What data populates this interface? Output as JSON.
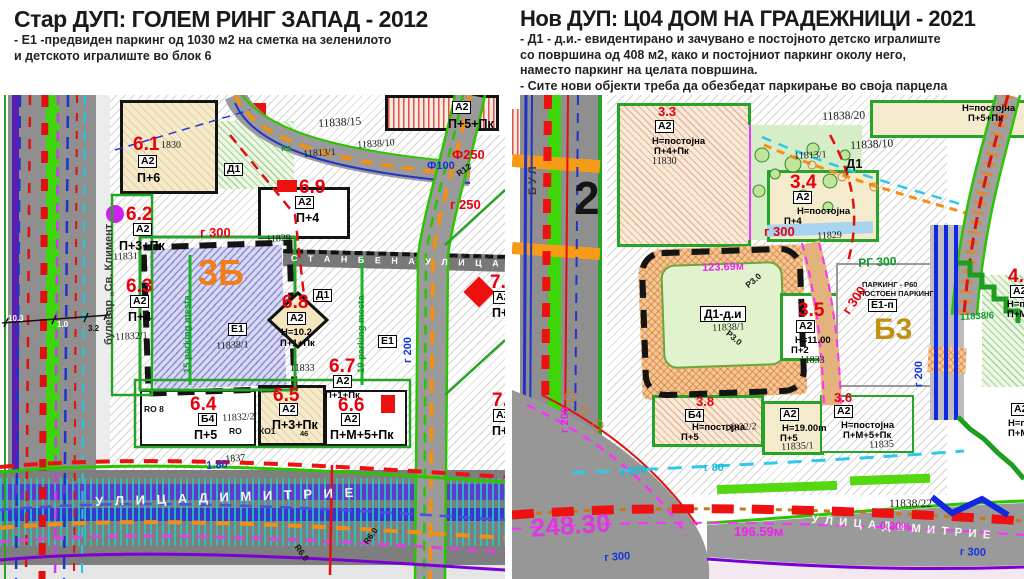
{
  "left_panel": {
    "title": "Стар ДУП: ГОЛЕМ РИНГ ЗАПАД - 2012",
    "notes": [
      "- Е1 -предвиден паркинг од 1030 м2 на сметка на зеленилото",
      "и детското игралиште во блок 6"
    ]
  },
  "right_panel": {
    "title": "Нов ДУП: Ц04 ДОМ НА ГРАДЕЖНИЦИ - 2021",
    "notes": [
      "- Д1 - д.и.- евидентирано и зачувано е постојното детско игралиште",
      "со површина од 408 м2, како и постојниот паркинг околу него,",
      "наместо паркинг на целата површина.",
      "- Сите нови објекти треба да обезбедат паркирање во своја парцела"
    ]
  },
  "left_map": {
    "caption": "Стар ДУП 2012 - урбанистичка карта",
    "labels": [
      {
        "n": "street-name-blvd",
        "t": "булевар „Св. Климент",
        "x": 104,
        "y": 250,
        "c": "blvd",
        "r": -90
      },
      {
        "n": "label-6-1",
        "t": "6.1",
        "x": 133,
        "y": 40,
        "c": "red"
      },
      {
        "n": "parcel-1830",
        "t": "1830",
        "x": 161,
        "y": 46,
        "c": "par"
      },
      {
        "n": "label-6-1-class",
        "t": "А2",
        "x": 138,
        "y": 60,
        "c": "box"
      },
      {
        "n": "label-6-1-storeys",
        "t": "П+6",
        "x": 137,
        "y": 77,
        "c": "st"
      },
      {
        "n": "label-6-2",
        "t": "6.2",
        "x": 126,
        "y": 110,
        "c": "red"
      },
      {
        "n": "label-6-2-class",
        "t": "А2",
        "x": 133,
        "y": 128,
        "c": "box"
      },
      {
        "n": "label-6-2-storeys",
        "t": "П+3+Пк",
        "x": 119,
        "y": 145,
        "c": "st"
      },
      {
        "n": "parcel-11831",
        "t": "11831",
        "x": 113,
        "y": 158,
        "c": "par",
        "r": -3
      },
      {
        "n": "label-6-3",
        "t": "6.3",
        "x": 126,
        "y": 182,
        "c": "red"
      },
      {
        "n": "label-6-3-class",
        "t": "А2",
        "x": 130,
        "y": 200,
        "c": "box"
      },
      {
        "n": "label-6-3-storeys",
        "t": "П+4",
        "x": 128,
        "y": 216,
        "c": "st"
      },
      {
        "n": "parcel-11832-1",
        "t": "11832/1",
        "x": 115,
        "y": 238,
        "c": "par",
        "r": -3
      },
      {
        "n": "label-3b",
        "t": "3Б",
        "x": 198,
        "y": 160,
        "c": "org3b"
      },
      {
        "n": "label-e1-box",
        "t": "Е1",
        "x": 228,
        "y": 228,
        "c": "box"
      },
      {
        "n": "parcel-11838-1",
        "t": "11838/1",
        "x": 216,
        "y": 247,
        "c": "par",
        "r": -3
      },
      {
        "n": "label-15-parking",
        "t": "15 parking mesta",
        "x": 183,
        "y": 278,
        "c": "grn",
        "r": -90
      },
      {
        "n": "label-19-parking",
        "t": "19 parking mesta",
        "x": 357,
        "y": 278,
        "c": "grn",
        "r": -90
      },
      {
        "n": "street-name-stanbena",
        "t": "С Т А Н Б Е Н А   У Л И Ц А   1",
        "x": 291,
        "y": 159,
        "c": "band-txt",
        "r": 1.5
      },
      {
        "n": "label-d1-top",
        "t": "Д1",
        "x": 224,
        "y": 68,
        "c": "box"
      },
      {
        "n": "label-d1-mid",
        "t": "Д1",
        "x": 313,
        "y": 194,
        "c": "box"
      },
      {
        "n": "label-6-8",
        "t": "6.8",
        "x": 282,
        "y": 198,
        "c": "red"
      },
      {
        "n": "label-6-8-class",
        "t": "А2",
        "x": 287,
        "y": 217,
        "c": "box"
      },
      {
        "n": "label-6-8-height",
        "t": "Н=10.2",
        "x": 281,
        "y": 233,
        "c": "st-s"
      },
      {
        "n": "label-6-8-storeys",
        "t": "П+1+Пк",
        "x": 280,
        "y": 244,
        "c": "st-s"
      },
      {
        "n": "label-6-7",
        "t": "6.7",
        "x": 329,
        "y": 262,
        "c": "red"
      },
      {
        "n": "label-6-7-class",
        "t": "А2",
        "x": 333,
        "y": 280,
        "c": "box"
      },
      {
        "n": "label-6-7-storeys",
        "t": "П+1+Пк",
        "x": 325,
        "y": 296,
        "c": "st-s"
      },
      {
        "n": "parcel-11833",
        "t": "11833",
        "x": 290,
        "y": 269,
        "c": "par"
      },
      {
        "n": "label-e1-right",
        "t": "Е1",
        "x": 378,
        "y": 240,
        "c": "box"
      },
      {
        "n": "label-6-9",
        "t": "6.9",
        "x": 299,
        "y": 83,
        "c": "red"
      },
      {
        "n": "label-6-9-class",
        "t": "А2",
        "x": 295,
        "y": 101,
        "c": "box"
      },
      {
        "n": "label-6-9-storeys",
        "t": "П+4",
        "x": 296,
        "y": 117,
        "c": "st"
      },
      {
        "n": "parcel-11829",
        "t": "11829",
        "x": 266,
        "y": 140,
        "c": "par",
        "r": -3
      },
      {
        "n": "parcel-11838-15",
        "t": "11838/15",
        "x": 318,
        "y": 24,
        "c": "par-b",
        "r": -3
      },
      {
        "n": "parcel-11838-10",
        "t": "11838/10",
        "x": 357,
        "y": 46,
        "c": "par",
        "r": -4
      },
      {
        "n": "parcel-11813-1",
        "t": "11813/1",
        "x": 303,
        "y": 55,
        "c": "par",
        "r": -4
      },
      {
        "n": "label-ks",
        "t": "ks",
        "x": 281,
        "y": 49,
        "c": "grn"
      },
      {
        "n": "label-a2-topright",
        "t": "А2",
        "x": 452,
        "y": 6,
        "c": "box"
      },
      {
        "n": "label-topright-storeys",
        "t": "П+5+Пк",
        "x": 448,
        "y": 23,
        "c": "st"
      },
      {
        "n": "label-f250",
        "t": "Ф250",
        "x": 452,
        "y": 53,
        "c": "red-s"
      },
      {
        "n": "label-f100",
        "t": "Ф100",
        "x": 427,
        "y": 66,
        "c": "blu-s"
      },
      {
        "n": "label-r12",
        "t": "R12",
        "x": 455,
        "y": 76,
        "c": "blk-s",
        "r": -35
      },
      {
        "n": "label-g250",
        "t": "г 250",
        "x": 450,
        "y": 103,
        "c": "red-s"
      },
      {
        "n": "label-g300",
        "t": "г 300",
        "x": 200,
        "y": 131,
        "c": "red-s"
      },
      {
        "n": "label-7-4",
        "t": "7.4",
        "x": 490,
        "y": 178,
        "c": "red"
      },
      {
        "n": "label-7-4-class",
        "t": "А2",
        "x": 493,
        "y": 196,
        "c": "box"
      },
      {
        "n": "label-7-4-storeys",
        "t": "П+1",
        "x": 492,
        "y": 212,
        "c": "st"
      },
      {
        "n": "label-7-x",
        "t": "7.",
        "x": 492,
        "y": 296,
        "c": "red"
      },
      {
        "n": "label-7-x-class",
        "t": "А2",
        "x": 493,
        "y": 314,
        "c": "box"
      },
      {
        "n": "label-7-x-storeys",
        "t": "П+1",
        "x": 492,
        "y": 330,
        "c": "st"
      },
      {
        "n": "label-6-4",
        "t": "6.4",
        "x": 190,
        "y": 300,
        "c": "red"
      },
      {
        "n": "label-6-4-class",
        "t": "Б4",
        "x": 198,
        "y": 318,
        "c": "box"
      },
      {
        "n": "label-6-4-storeys",
        "t": "П+5",
        "x": 194,
        "y": 334,
        "c": "st"
      },
      {
        "n": "label-ro8",
        "t": "RO 8",
        "x": 144,
        "y": 310,
        "c": "blk-s"
      },
      {
        "n": "parcel-11832-2",
        "t": "11832/2",
        "x": 222,
        "y": 319,
        "c": "par",
        "r": -3
      },
      {
        "n": "label-ro",
        "t": "RO",
        "x": 229,
        "y": 332,
        "c": "blk-s"
      },
      {
        "n": "label-6-5",
        "t": "6.5",
        "x": 273,
        "y": 291,
        "c": "red"
      },
      {
        "n": "label-6-5-class",
        "t": "А2",
        "x": 279,
        "y": 308,
        "c": "box"
      },
      {
        "n": "label-6-5-storeys",
        "t": "П+3+Пк",
        "x": 272,
        "y": 324,
        "c": "st"
      },
      {
        "n": "label-ko1",
        "t": "КО1",
        "x": 259,
        "y": 332,
        "c": "blk-s"
      },
      {
        "n": "label-46",
        "t": "46",
        "x": 300,
        "y": 335,
        "c": "blk-xs"
      },
      {
        "n": "label-6-6",
        "t": "6.6",
        "x": 338,
        "y": 301,
        "c": "red"
      },
      {
        "n": "label-6-6-class",
        "t": "А2",
        "x": 341,
        "y": 318,
        "c": "box"
      },
      {
        "n": "label-6-6-storeys",
        "t": "П+М+5+Пк",
        "x": 330,
        "y": 334,
        "c": "st"
      },
      {
        "n": "parcel-1837",
        "t": "1837",
        "x": 225,
        "y": 360,
        "c": "par",
        "r": -4
      },
      {
        "n": "label-1-80",
        "t": "1.80",
        "x": 206,
        "y": 366,
        "c": "blu-s",
        "r": -4
      },
      {
        "n": "street-name-dimitrije",
        "t": "У Л И Ц А   Д И М И Т Р И Е",
        "x": 95,
        "y": 400,
        "c": "street-w",
        "r": -2
      },
      {
        "n": "label-r6-0-a",
        "t": "R6.0",
        "x": 300,
        "y": 448,
        "c": "blk-s",
        "r": 55
      },
      {
        "n": "label-r6-0-b",
        "t": "R6.0",
        "x": 362,
        "y": 446,
        "c": "blk-s",
        "r": -55
      },
      {
        "n": "label-g200",
        "t": "г 200",
        "x": 403,
        "y": 268,
        "c": "blu-s",
        "r": -90
      },
      {
        "n": "dim-10-3",
        "t": "10.3",
        "x": 8,
        "y": 220,
        "c": "dim-w"
      },
      {
        "n": "dim-1-0",
        "t": "1.0",
        "x": 57,
        "y": 226,
        "c": "dim-w"
      },
      {
        "n": "dim-3-2",
        "t": "3.2",
        "x": 88,
        "y": 230,
        "c": "dim-b"
      }
    ]
  },
  "right_map": {
    "caption": "Нов ДУП 2021 - урбанистичка карта",
    "labels": [
      {
        "n": "street-name-bul",
        "t": "Б У Л",
        "x": 16,
        "y": 100,
        "c": "blvd",
        "r": -90
      },
      {
        "n": "label-block-2",
        "t": "2",
        "x": 62,
        "y": 80,
        "c": "big2"
      },
      {
        "n": "label-3-3",
        "t": "3.3",
        "x": 146,
        "y": 10,
        "c": "red-s"
      },
      {
        "n": "label-3-3-class",
        "t": "А2",
        "x": 143,
        "y": 25,
        "c": "box"
      },
      {
        "n": "label-3-3-height",
        "t": "Н=постојна",
        "x": 140,
        "y": 42,
        "c": "st-s"
      },
      {
        "n": "label-3-3-storeys",
        "t": "П+4+Пк",
        "x": 142,
        "y": 52,
        "c": "st-s"
      },
      {
        "n": "parcel-11830",
        "t": "11830",
        "x": 140,
        "y": 62,
        "c": "par"
      },
      {
        "n": "label-d1-park",
        "t": "Д1",
        "x": 334,
        "y": 62,
        "c": "blk-b"
      },
      {
        "n": "label-g300-top",
        "t": "г 300",
        "x": 252,
        "y": 130,
        "c": "red-s"
      },
      {
        "n": "label-3-4",
        "t": "3.4",
        "x": 278,
        "y": 78,
        "c": "red"
      },
      {
        "n": "label-3-4-class",
        "t": "А2",
        "x": 281,
        "y": 96,
        "c": "box"
      },
      {
        "n": "label-3-4-height",
        "t": "Н=постојна",
        "x": 285,
        "y": 112,
        "c": "st-s"
      },
      {
        "n": "label-3-4-storeys",
        "t": "П+4",
        "x": 272,
        "y": 122,
        "c": "st-s"
      },
      {
        "n": "parcel-11829-r",
        "t": "11829",
        "x": 305,
        "y": 137,
        "c": "par",
        "r": -3
      },
      {
        "n": "parcel-11838-20",
        "t": "11838/20",
        "x": 310,
        "y": 17,
        "c": "par-b",
        "r": -2
      },
      {
        "n": "label-topright-height",
        "t": "Н=постојна",
        "x": 450,
        "y": 9,
        "c": "st-s"
      },
      {
        "n": "label-topright-storeys",
        "t": "П+5+Пк",
        "x": 456,
        "y": 19,
        "c": "st-s"
      },
      {
        "n": "parcel-11838-10-r",
        "t": "11838/10",
        "x": 338,
        "y": 46,
        "c": "par-b",
        "r": -3
      },
      {
        "n": "parcel-11813-1-r",
        "t": "11813/1",
        "x": 282,
        "y": 57,
        "c": "par",
        "r": -3
      },
      {
        "n": "label-d1-di",
        "t": "Д1-д.и",
        "x": 188,
        "y": 211,
        "c": "box-b"
      },
      {
        "n": "parcel-11838-1-r",
        "t": "11838/1",
        "x": 200,
        "y": 229,
        "c": "par",
        "r": -3
      },
      {
        "n": "label-123-69",
        "t": "123.69м",
        "x": 190,
        "y": 168,
        "c": "mag-s",
        "r": -2
      },
      {
        "n": "label-r3-0-a",
        "t": "Р3.0",
        "x": 232,
        "y": 188,
        "c": "blk-s",
        "r": -40
      },
      {
        "n": "label-r3-0-b",
        "t": "Р3.0",
        "x": 218,
        "y": 234,
        "c": "blk-s",
        "r": 40
      },
      {
        "n": "label-3-5",
        "t": "3.5",
        "x": 286,
        "y": 206,
        "c": "red"
      },
      {
        "n": "label-3-5-class",
        "t": "А2",
        "x": 284,
        "y": 225,
        "c": "box"
      },
      {
        "n": "label-3-5-height",
        "t": "Н=11.00",
        "x": 283,
        "y": 241,
        "c": "st-s"
      },
      {
        "n": "label-3-5-storeys",
        "t": "П+2",
        "x": 279,
        "y": 251,
        "c": "st-s"
      },
      {
        "n": "parcel-11833-r",
        "t": "11833",
        "x": 288,
        "y": 261,
        "c": "par"
      },
      {
        "n": "label-rg-300",
        "t": "РГ 300",
        "x": 346,
        "y": 162,
        "c": "grn-b",
        "r": -3
      },
      {
        "n": "label-parking-r60",
        "t": "ПАРКИНГ - Р60",
        "x": 350,
        "y": 186,
        "c": "blk-xs"
      },
      {
        "n": "label-postoen-parking",
        "t": "ПОСТОЕН ПАРКИНГ",
        "x": 347,
        "y": 195,
        "c": "blk-xs"
      },
      {
        "n": "label-e1-p",
        "t": "Е1-п",
        "x": 356,
        "y": 204,
        "c": "box"
      },
      {
        "n": "label-b3",
        "t": "Б3",
        "x": 362,
        "y": 220,
        "c": "b3"
      },
      {
        "n": "label-g300-diag",
        "t": "г 300",
        "x": 328,
        "y": 214,
        "c": "red-s",
        "r": -55
      },
      {
        "n": "label-g200-vert",
        "t": "г 200",
        "x": 402,
        "y": 292,
        "c": "blu-s",
        "r": -90
      },
      {
        "n": "parcel-11838-6",
        "t": "11838/6",
        "x": 448,
        "y": 218,
        "c": "grn",
        "r": -3
      },
      {
        "n": "label-4-2",
        "t": "4.2",
        "x": 496,
        "y": 172,
        "c": "red"
      },
      {
        "n": "label-4-2-class",
        "t": "А2",
        "x": 498,
        "y": 190,
        "c": "box"
      },
      {
        "n": "label-4-2-height",
        "t": "Н=пос",
        "x": 495,
        "y": 205,
        "c": "st-s"
      },
      {
        "n": "label-4-2-storeys",
        "t": "П+М+1",
        "x": 495,
        "y": 215,
        "c": "st-s"
      },
      {
        "n": "label-3-8",
        "t": "3.8",
        "x": 184,
        "y": 300,
        "c": "red-s"
      },
      {
        "n": "label-b4-class",
        "t": "Б4",
        "x": 173,
        "y": 314,
        "c": "box"
      },
      {
        "n": "label-b4-height",
        "t": "Н=постојна",
        "x": 180,
        "y": 328,
        "c": "st-s"
      },
      {
        "n": "parcel-11832-2-r",
        "t": "11832/2",
        "x": 212,
        "y": 329,
        "c": "par",
        "r": -3
      },
      {
        "n": "label-b4-storeys",
        "t": "П+5",
        "x": 169,
        "y": 338,
        "c": "st-s"
      },
      {
        "n": "label-a2-19-class",
        "t": "А2",
        "x": 268,
        "y": 313,
        "c": "box"
      },
      {
        "n": "label-a2-19-height",
        "t": "Н=19.00m",
        "x": 270,
        "y": 329,
        "c": "st-s"
      },
      {
        "n": "label-a2-19-storeys",
        "t": "П+5",
        "x": 268,
        "y": 339,
        "c": "st-s"
      },
      {
        "n": "parcel-11835-1",
        "t": "11835/1",
        "x": 269,
        "y": 348,
        "c": "par",
        "r": -3
      },
      {
        "n": "label-3-6",
        "t": "3.6",
        "x": 322,
        "y": 296,
        "c": "red-s"
      },
      {
        "n": "label-3-6-class",
        "t": "А2",
        "x": 322,
        "y": 310,
        "c": "box"
      },
      {
        "n": "label-3-6-height",
        "t": "Н=постојна",
        "x": 329,
        "y": 326,
        "c": "st-s"
      },
      {
        "n": "label-3-6-storeys",
        "t": "П+М+5+Пк",
        "x": 331,
        "y": 336,
        "c": "st-s"
      },
      {
        "n": "parcel-11835",
        "t": "11835",
        "x": 357,
        "y": 346,
        "c": "par",
        "r": -3
      },
      {
        "n": "label-a2-edge",
        "t": "А2",
        "x": 499,
        "y": 308,
        "c": "box"
      },
      {
        "n": "label-a2-edge-height",
        "t": "Н=пост",
        "x": 496,
        "y": 324,
        "c": "st-s"
      },
      {
        "n": "label-a2-edge-storeys",
        "t": "П+М+1",
        "x": 496,
        "y": 334,
        "c": "st-s"
      },
      {
        "n": "parcel-11838-22",
        "t": "11838/22",
        "x": 377,
        "y": 404,
        "c": "par-b"
      },
      {
        "n": "label-248-30",
        "t": "248.30",
        "x": 18,
        "y": 420,
        "c": "mag-big",
        "r": -4
      },
      {
        "n": "label-196-59",
        "t": "196.59м",
        "x": 222,
        "y": 430,
        "c": "mag-s2"
      },
      {
        "n": "street-name-dimitrie-r",
        "t": "У Л И Ц А   Д И М И Т Р И Е",
        "x": 300,
        "y": 420,
        "c": "street-w2",
        "r": 5
      },
      {
        "n": "label-0-30-percent",
        "t": "0.30%",
        "x": 368,
        "y": 426,
        "c": "mag-s",
        "r": 3
      },
      {
        "n": "label-g300-blue",
        "t": "г 300",
        "x": 448,
        "y": 452,
        "c": "blu-s",
        "r": 2
      },
      {
        "n": "label-g80",
        "t": "г 80",
        "x": 192,
        "y": 368,
        "c": "cyn"
      },
      {
        "n": "label-g200-cyan",
        "t": "г 200",
        "x": 108,
        "y": 374,
        "c": "cyn",
        "r": -10
      },
      {
        "n": "label-g200-mag",
        "t": "г 200",
        "x": 48,
        "y": 338,
        "c": "mag-s",
        "r": -90
      },
      {
        "n": "label-g300-blue2",
        "t": "г 300",
        "x": 92,
        "y": 458,
        "c": "blu-s",
        "r": -4
      }
    ]
  }
}
